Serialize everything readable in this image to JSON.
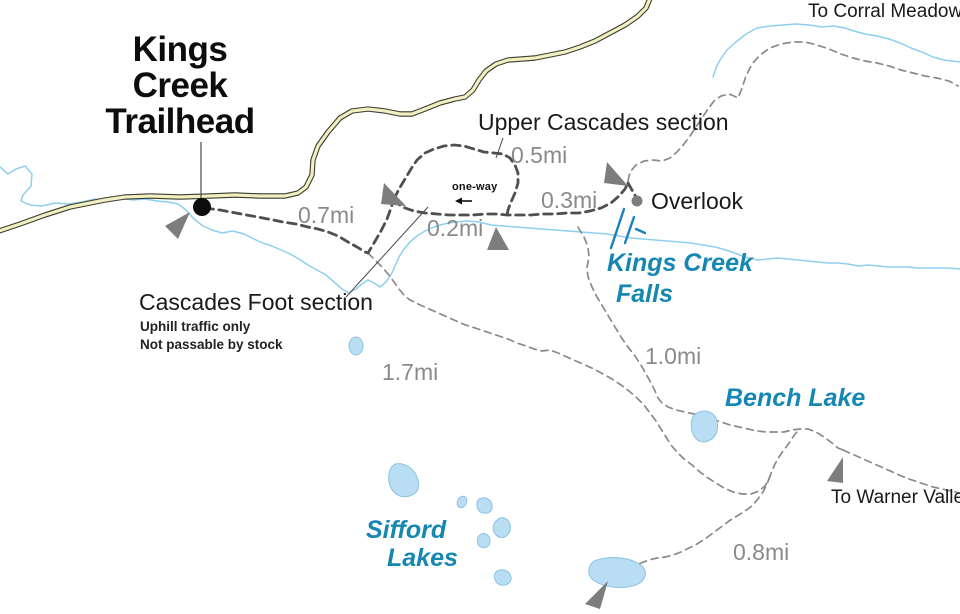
{
  "title": {
    "line1": "Kings",
    "line2": "Creek",
    "line3": "Trailhead"
  },
  "labels": {
    "to_corral_meadow": "To Corral Meadow",
    "upper_cascades_section": "Upper Cascades section",
    "overlook": "Overlook",
    "kings_creek_falls": {
      "line1": "Kings Creek",
      "line2": "Falls"
    },
    "cascades_foot_section": "Cascades Foot section",
    "uphill_note": "Uphill traffic only",
    "stock_note": "Not passable by stock",
    "one_way": "one-way",
    "bench_lake": "Bench Lake",
    "sifford_lakes": {
      "line1": "Sifford",
      "line2": "Lakes"
    },
    "to_warner_valley": "To Warner Valley"
  },
  "distances": {
    "trailhead_to_cascades": "0.7mi",
    "upper_cascades_loop": "0.5mi",
    "one_way_section": "0.2mi",
    "cascades_to_overlook": "0.3mi",
    "falls_to_bench_lake": "1.0mi",
    "cascades_to_sifford": "1.7mi",
    "sifford_to_bench": "0.8mi"
  },
  "colors": {
    "background": "#ffffff",
    "road_fill": "#f2efc2",
    "road_casing": "#3d3c2e",
    "creek": "#8ecfee",
    "lake_fill": "#b9ddf2",
    "lake_stroke": "#8cc3e4",
    "falls_symbol": "#1b80c0",
    "water_label": "#1687b2",
    "trail_main": "#4f4f4f",
    "trail_secondary": "#8a8a8a",
    "distance_label": "#8a8a8a",
    "map_text": "#1a1a1a",
    "marker": "#7d7d7d",
    "leader_line": "#4a4a4a"
  }
}
